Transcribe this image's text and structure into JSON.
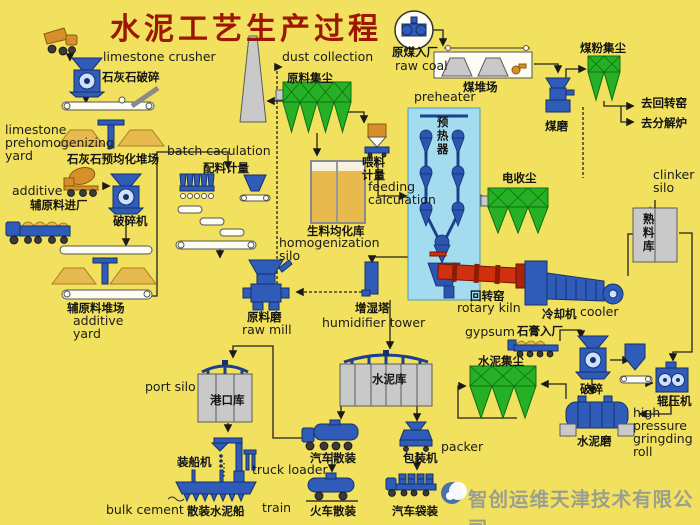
{
  "title": "水泥工艺生产过程",
  "watermark": "智创运维天津技术有限公司",
  "colors": {
    "background": "#f1e15e",
    "title_red": "#9b1702",
    "equipment_blue": "#2e5cb8",
    "dust_collector_green": "#25b025",
    "kiln_red": "#d03010",
    "silo_gray": "#c9c9c9",
    "pile_sand": "#e7ba50",
    "preheater_lightblue": "#a3dcef",
    "watermark_gray": "#8e9399"
  },
  "labels": {
    "limestone_crusher_en": "limestone crusher",
    "limestone_crusher_zh": "石灰石破碎",
    "limestone_yard_en": "limestone prehomogenizing yard",
    "limestone_yard_zh": "石灰石预均化堆场",
    "batch_calculation_en": "batch caculation",
    "batch_calculation_zh": "配料计量",
    "dust_collection_en": "dust collection",
    "dust_collection_zh": "原料集尘",
    "raw_coal_zh": "原煤入厂",
    "raw_coal_en": "raw coal",
    "coal_yard_zh": "煤堆场",
    "coal_dust_zh": "煤粉集尘",
    "coal_mill_zh": "煤磨",
    "to_rotary_kiln_zh": "去回转窑",
    "to_calciner_zh": "去分解炉",
    "preheater_en": "preheater",
    "preheater_zh": "预热器",
    "feeding_zh": "喂料计量",
    "feeding_en": "feeding calculation",
    "homogenization_zh": "生料均化库",
    "homogenization_en": "homogenization silo",
    "additive_en": "additive",
    "additive_in_zh": "辅原料进厂",
    "additive_crusher_zh": "破碎机",
    "additive_yard_zh": "辅原料堆场",
    "additive_yard_en": "additive yard",
    "raw_mill_zh": "原料磨",
    "raw_mill_en": "raw mill",
    "esp_zh": "电收尘",
    "clinker_silo_en": "clinker silo",
    "clinker_silo_zh": "熟料库",
    "rotary_kiln_zh": "回转窑",
    "rotary_kiln_en": "rotary kiln",
    "cooler_zh": "冷却机",
    "cooler_en": "cooler",
    "humidifier_zh": "增湿塔",
    "humidifier_en": "humidifier tower",
    "gypsum_en": "gypsum",
    "gypsum_zh": "石膏入厂",
    "cement_dust_zh": "水泥集尘",
    "gypsum_crusher_zh": "破碎",
    "roller_press_zh": "辊压机",
    "roller_press_en": "high pressure gringding roll",
    "cement_mill_zh": "水泥磨",
    "port_silo_en": "port silo",
    "port_silo_zh": "港口库",
    "cement_silo_zh": "水泥库",
    "ship_loader_zh": "装船机",
    "truck_loader_en": "truck loader",
    "truck_bulk_zh": "汽车散装",
    "packer_zh": "包装机",
    "packer_en": "packer",
    "bulk_cement_en": "bulk cement",
    "bulk_ship_zh": "散装水泥船",
    "train_en": "train",
    "train_bulk_zh": "火车散装",
    "truck_bag_zh": "汽车袋装"
  },
  "icons": [
    "dump-truck-icon",
    "limestone-crusher-icon",
    "limestone-yard-icon",
    "chimney-icon",
    "raw-dust-collector-icon",
    "coal-crusher-circle-icon",
    "coal-yard-icon",
    "coal-mill-icon",
    "coal-dust-filter-icon",
    "mixer-truck-icon",
    "flatbed-truck-icon",
    "additive-crusher-icon",
    "batch-hoppers-icon",
    "batch-conveyors-icon",
    "additive-yard-icon",
    "raw-mill-icon",
    "homogenization-tank",
    "feeder-icon",
    "preheater-tower-icon",
    "esp-icon",
    "rotary-kiln-icon",
    "cooler-icon",
    "clinker-silo-icon",
    "humidifier-icon",
    "gypsum-truck-icon",
    "cement-dust-collector-icon",
    "gypsum-crusher-icon",
    "surge-hopper-icon",
    "roller-press-icon",
    "cement-mill-icon",
    "cement-silo-icon",
    "port-silo-icon",
    "bulk-truck-icon",
    "packer-icon",
    "bag-truck-icon",
    "train-car-icon",
    "ship-icon",
    "ship-loader-icon",
    "company-logo-icon"
  ]
}
